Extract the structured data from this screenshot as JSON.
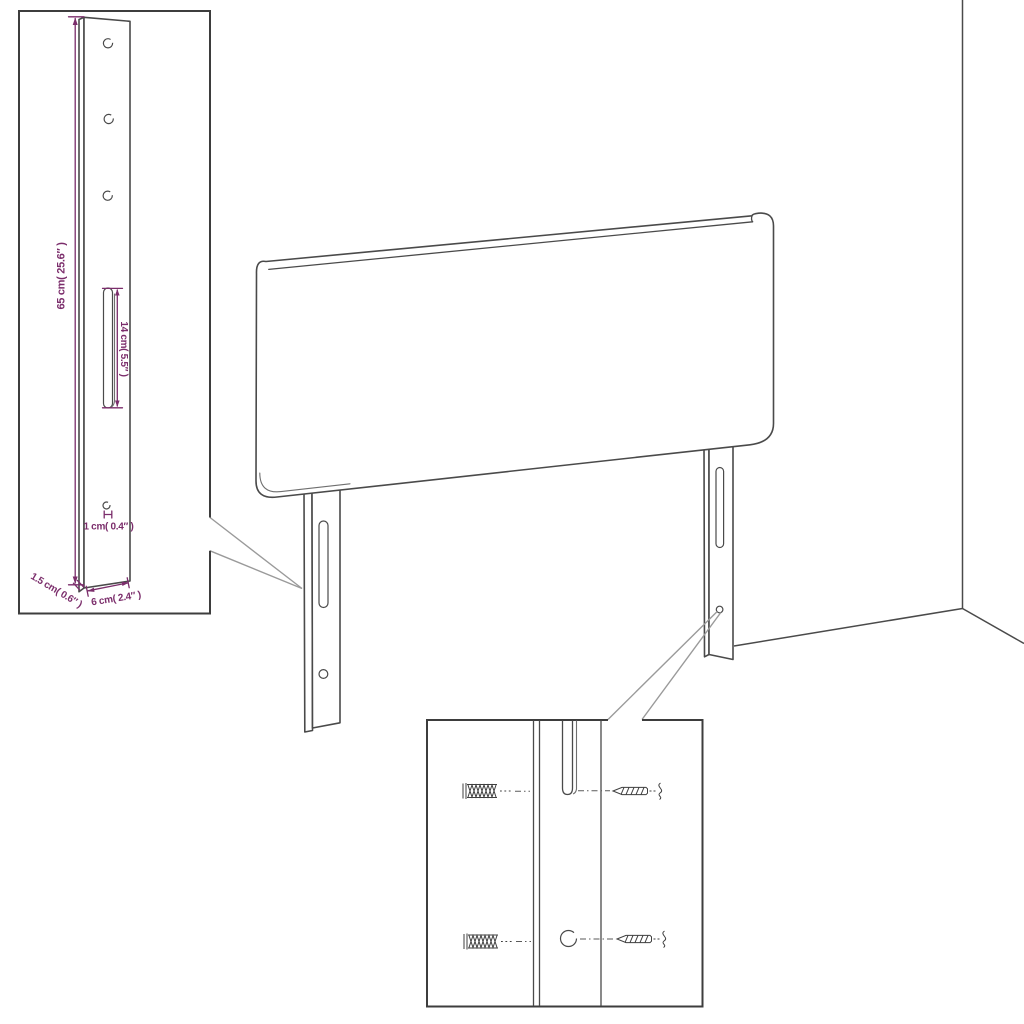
{
  "title": "Headboard assembly dimension diagram",
  "colors": {
    "background": "#ffffff",
    "drawing_line": "#4a4a4a",
    "inset_border": "#3d3d3d",
    "dimension": "#7b2d6b",
    "callout_leader": "#9a9a9a"
  },
  "main_view": {
    "object": "upholstered headboard panel with two slotted mounting legs",
    "environment": "room corner with wall and floor edge lines"
  },
  "leg_detail_inset": {
    "name": "leg-bracket-detail-callout",
    "dimensions": {
      "height": "65 cm( 25.6″ )",
      "slot_length": "14 cm( 5.5″ )",
      "hole_diameter": "1 cm( 0.4″ )",
      "thickness": "1.5 cm( 0.6″ )",
      "width": "6 cm( 2.4″ )"
    },
    "features": [
      "three-round-holes",
      "adjustment-slot",
      "bottom-screw-hole"
    ]
  },
  "hardware_inset": {
    "name": "wall-mounting-detail-callout",
    "parts": [
      "wall-anchor-upper",
      "wall-anchor-lower",
      "screw-upper",
      "screw-lower",
      "leg-slot",
      "leg-hole"
    ]
  }
}
